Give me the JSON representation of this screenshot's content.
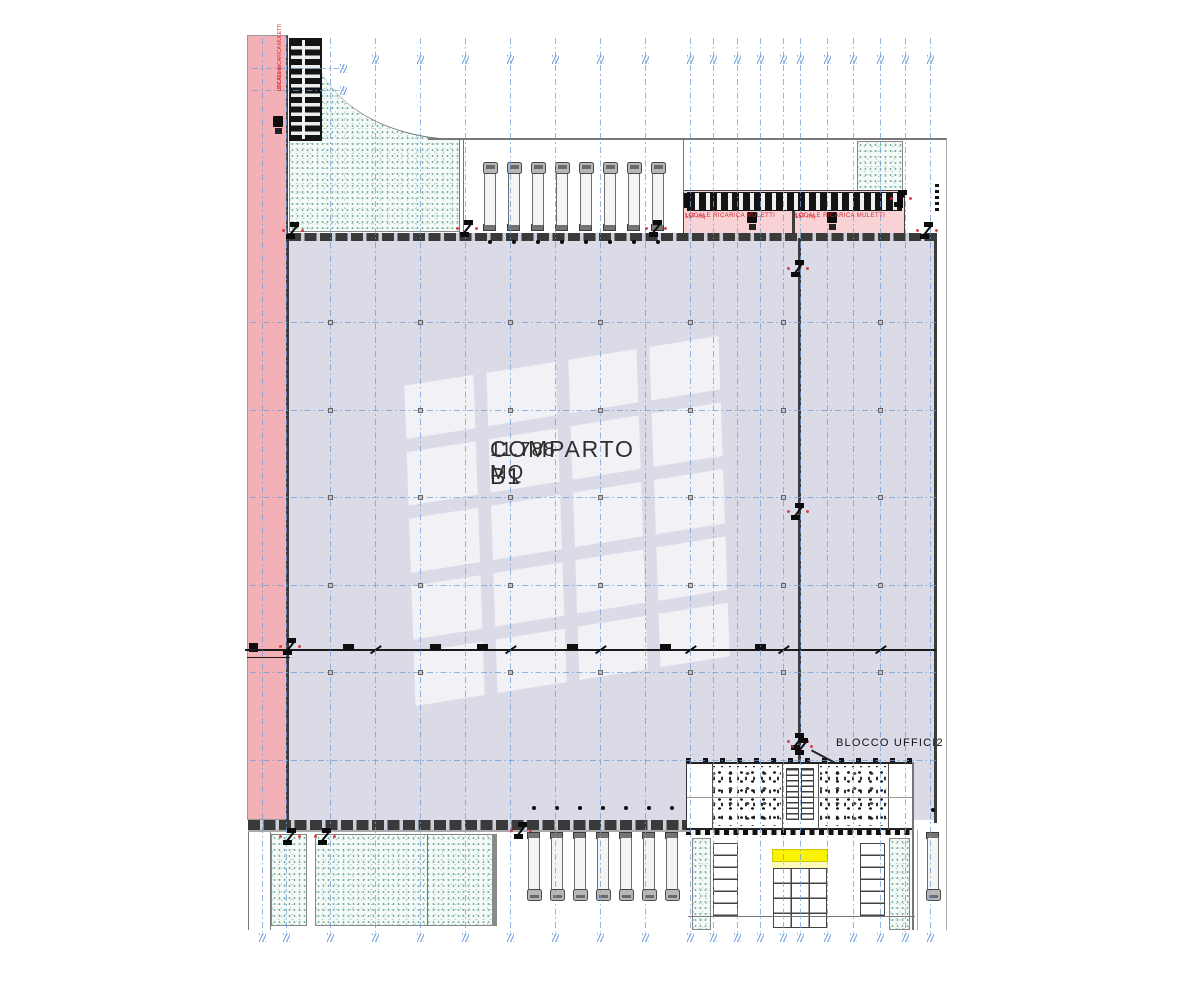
{
  "drawing": {
    "main_label": {
      "title": "COMPARTO B1",
      "area": "11.788 MQ"
    },
    "office_block_label": "BLOCCO UFFICI2",
    "charging_rooms": [
      {
        "name": "LOCALE RICARICA MULETTI",
        "area": "157 mq"
      },
      {
        "name": "LOCALE RICARICA MULETTI",
        "area": "157 mq"
      }
    ],
    "charging_room_side": {
      "name": "LOCALE RICARICA MULETTI",
      "area": "191.78 mq"
    }
  },
  "colors": {
    "hall_fill": "#dbdbe8",
    "parking_pink": "#f3b0b6",
    "room_pink": "#f8d2d5",
    "highlight_yellow": "#f9f303",
    "grid_blue": "#6f9fd8",
    "stipple_green": "#96c2b2",
    "annotation_red": "#d6262c",
    "wall_dark": "#3c3c3c"
  },
  "plan": {
    "grid_vertical_x": [
      262,
      286,
      330,
      375,
      420,
      465,
      510,
      555,
      600,
      645,
      690,
      713,
      737,
      760,
      783,
      800,
      827,
      853,
      880,
      905,
      930
    ],
    "grid_horizontal_y": [
      322,
      410,
      497,
      585,
      672,
      760
    ],
    "grid_short_horizontal_y": [
      68,
      90
    ],
    "column_marker_x": [
      330,
      420,
      510,
      600,
      690,
      783,
      880
    ],
    "column_marker_y": [
      322,
      410,
      497,
      585,
      672
    ],
    "trucks_top_x": [
      482,
      506,
      530,
      554,
      578,
      602,
      626,
      650
    ],
    "trucks_bottom_x": [
      526,
      549,
      572,
      595,
      618,
      641,
      664
    ],
    "truck_right": {
      "x": 925,
      "y": 832
    },
    "section_line_y": 650,
    "section_ticks_x": [
      343,
      430,
      477,
      567,
      660,
      755
    ],
    "section_slashes_x": [
      375,
      510,
      600,
      690,
      783,
      880
    ],
    "doors": [
      [
        286,
        222
      ],
      [
        460,
        220
      ],
      [
        649,
        220
      ],
      [
        791,
        260
      ],
      [
        791,
        503
      ],
      [
        791,
        733
      ],
      [
        795,
        738
      ],
      [
        283,
        638
      ],
      [
        283,
        828
      ],
      [
        318,
        828
      ],
      [
        514,
        822
      ],
      [
        894,
        190
      ],
      [
        920,
        222
      ]
    ],
    "forklifts": [
      [
        746,
        212
      ],
      [
        826,
        212
      ],
      [
        272,
        116
      ]
    ]
  }
}
